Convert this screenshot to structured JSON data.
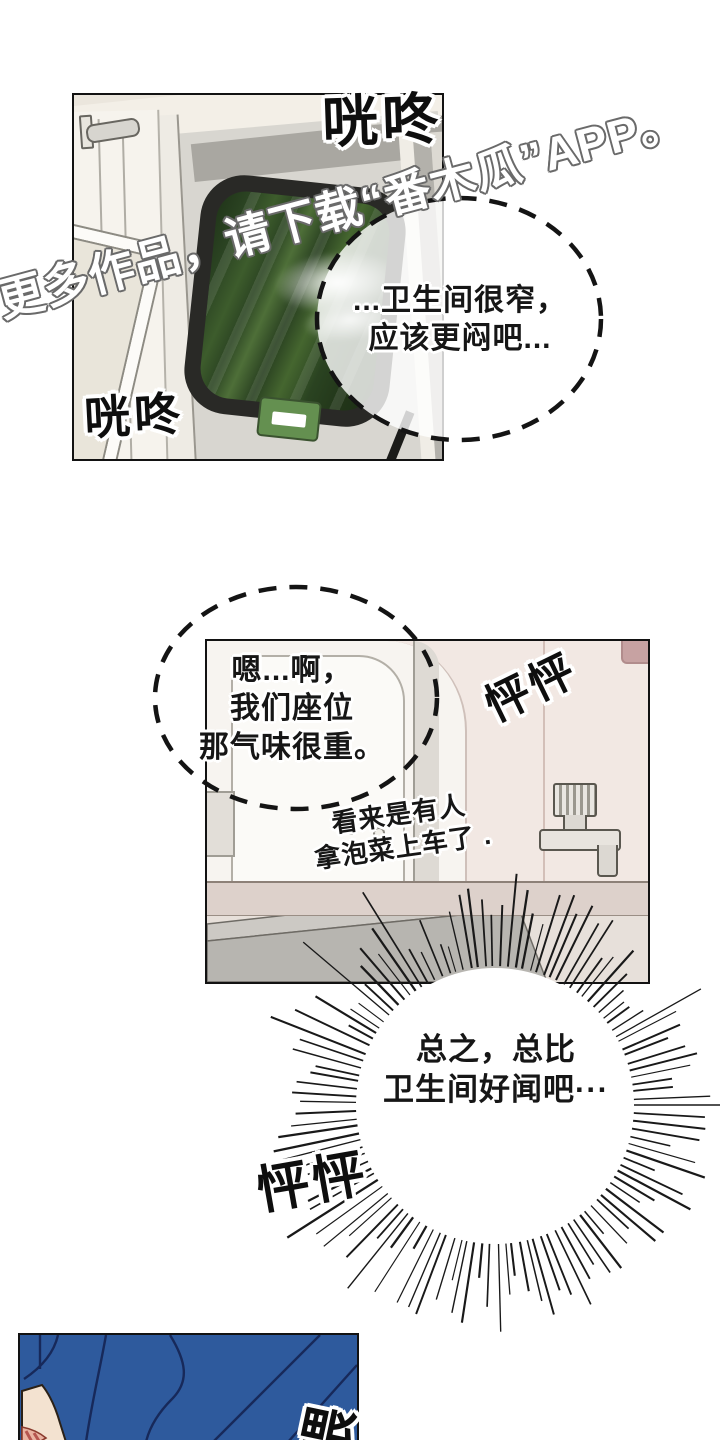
{
  "watermark": {
    "text": "更多作品，请下载“番木瓜”APP。"
  },
  "sfx": {
    "clang_top": "咣咚",
    "clang_bottom": "咣咚",
    "heartbeat_mid": "怦怦",
    "heartbeat_bottom": "怦怦",
    "hey": "喂"
  },
  "dialogue": {
    "toilet_bubble": {
      "line1": "...卫生间很窄，",
      "line2": "应该更闷吧..."
    },
    "seat_bubble": {
      "line1": "嗯...啊，",
      "line2": "我们座位",
      "line3": "那气味很重。"
    },
    "narration": {
      "line1": "看来是有人",
      "line2": "拿泡菜上车了 ."
    },
    "burst_bubble": {
      "line1": "总之，总比",
      "line2": "卫生间好闻吧···"
    }
  },
  "colors": {
    "jacket_blue": "#2E5A9D",
    "jacket_line": "#17295A",
    "scenery_green": "#35522A",
    "sign_green": "#649050",
    "wall_cream": "#EBE6DD",
    "wall_pink": "#F2E8E3",
    "corner_rose": "#C7A2A2",
    "skin": "#F3E2D0"
  }
}
